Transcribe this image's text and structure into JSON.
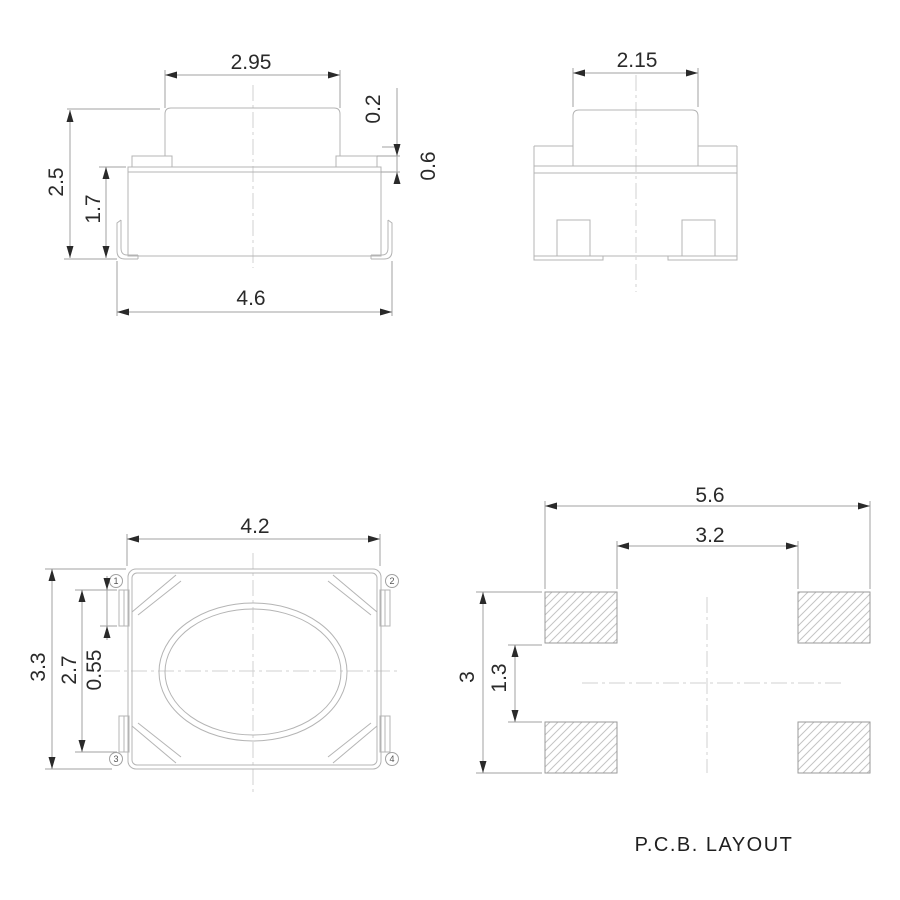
{
  "drawing": {
    "background": "#ffffff",
    "colors": {
      "outline": "#b4b4b4",
      "dimension_line": "#a2a2a2",
      "centerline": "#d2d2d2",
      "arrow_and_text": "#2a2a2a",
      "hatch": "#c4c4c4"
    },
    "front_view": {
      "dims": {
        "actuator_width": "2.95",
        "flange_step": "0.2",
        "bump_height": "0.6",
        "total_height": "2.5",
        "body_height": "1.7",
        "overall_width": "4.6"
      }
    },
    "side_view": {
      "dims": {
        "actuator_depth": "2.15"
      }
    },
    "top_view": {
      "dims": {
        "body_width": "4.2",
        "overall_depth": "3.3",
        "terminal_span": "2.7",
        "terminal_width": "0.55"
      },
      "pins": [
        "1",
        "2",
        "3",
        "4"
      ]
    },
    "pcb_view": {
      "title": "P.C.B. LAYOUT",
      "dims": {
        "pad_outer_width": "5.6",
        "pad_inner_width": "3.2",
        "pad_outer_height": "3",
        "pad_inner_height": "1.3"
      }
    }
  }
}
